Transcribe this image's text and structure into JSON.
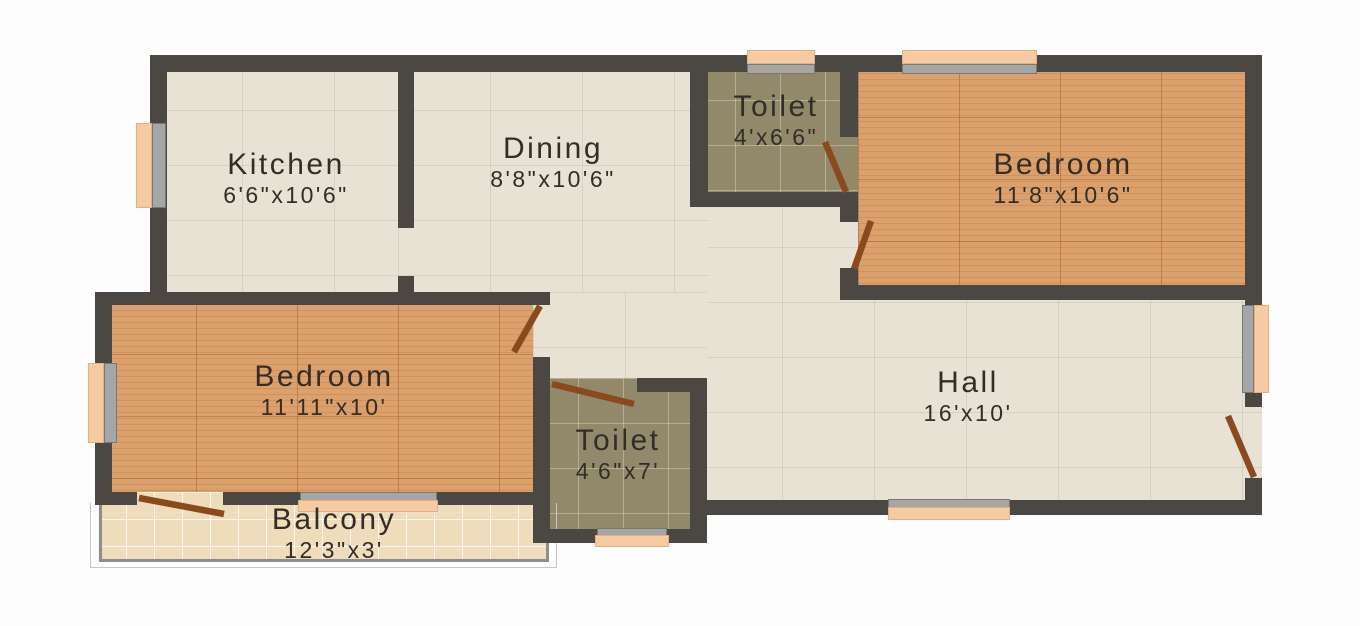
{
  "title": "2BHK Floor Plan",
  "colors": {
    "wall": "#4b4742",
    "floor_ceramic": "#e7e2d4",
    "floor_wood": "#dca06c",
    "floor_toilet_tile": "#92896b",
    "floor_balcony_tile": "#eedcba",
    "window_glass": "#f7cba2",
    "window_frame": "#a6a6a6",
    "door_leaf": "#8a4a1e",
    "label_text": "#332d27",
    "background": "#fdfdfd"
  },
  "rooms": [
    {
      "id": "kitchen",
      "name": "Kitchen",
      "dimensions": "6'6\"x10'6\"",
      "floor": "ceramic"
    },
    {
      "id": "dining",
      "name": "Dining",
      "dimensions": "8'8\"x10'6\"",
      "floor": "ceramic"
    },
    {
      "id": "toilet-top",
      "name": "Toilet",
      "dimensions": "4'x6'6\"",
      "floor": "toilet"
    },
    {
      "id": "bedroom-right",
      "name": "Bedroom",
      "dimensions": "11'8\"x10'6\"",
      "floor": "wood"
    },
    {
      "id": "bedroom-left",
      "name": "Bedroom",
      "dimensions": "11'11\"x10'",
      "floor": "wood"
    },
    {
      "id": "hall",
      "name": "Hall",
      "dimensions": "16'x10'",
      "floor": "ceramic"
    },
    {
      "id": "toilet-bottom",
      "name": "Toilet",
      "dimensions": "4'6\"x7'",
      "floor": "toilet"
    },
    {
      "id": "balcony",
      "name": "Balcony",
      "dimensions": "12'3\"x3'",
      "floor": "balcony"
    }
  ],
  "plan": {
    "width": 1360,
    "height": 626,
    "floors": [
      {
        "id": "hall",
        "type": "ceramic",
        "rect": [
          690,
          192,
          572,
          323
        ]
      },
      {
        "id": "bedroom-right",
        "type": "wood",
        "rect": [
          858,
          55,
          404,
          245
        ]
      },
      {
        "id": "toilet-top",
        "type": "toilet",
        "rect": [
          690,
          55,
          168,
          152
        ]
      },
      {
        "id": "kitchen",
        "type": "ceramic",
        "rect": [
          150,
          55,
          264,
          250
        ]
      },
      {
        "id": "dining",
        "type": "ceramic",
        "rect": [
          398,
          55,
          310,
          250
        ]
      },
      {
        "id": "bedroom-left",
        "type": "wood",
        "rect": [
          95,
          292,
          455,
          200
        ]
      },
      {
        "id": "corridor",
        "type": "ceramic",
        "rect": [
          533,
          292,
          174,
          100
        ]
      },
      {
        "id": "toilet-bottom",
        "type": "toilet",
        "rect": [
          533,
          378,
          174,
          165
        ]
      },
      {
        "id": "balcony",
        "type": "balcony",
        "rect": [
          98,
          492,
          450,
          70
        ]
      }
    ],
    "railing": [
      {
        "cls": "rail-outer",
        "rect": [
          90,
          503,
          467,
          65
        ]
      },
      {
        "cls": "rail-inner",
        "rect": [
          99,
          503,
          450,
          59
        ]
      }
    ],
    "walls": [
      [
        150,
        55,
        1112,
        17
      ],
      [
        150,
        55,
        17,
        250
      ],
      [
        398,
        72,
        16,
        156
      ],
      [
        398,
        276,
        16,
        29
      ],
      [
        690,
        55,
        18,
        152
      ],
      [
        690,
        192,
        168,
        15
      ],
      [
        840,
        72,
        18,
        65
      ],
      [
        840,
        192,
        18,
        30
      ],
      [
        840,
        268,
        18,
        32
      ],
      [
        1245,
        55,
        17,
        352
      ],
      [
        1245,
        478,
        17,
        37
      ],
      [
        840,
        285,
        422,
        15
      ],
      [
        690,
        500,
        572,
        15
      ],
      [
        95,
        292,
        455,
        13
      ],
      [
        95,
        292,
        17,
        213
      ],
      [
        95,
        492,
        42,
        13
      ],
      [
        223,
        492,
        214,
        13
      ],
      [
        437,
        492,
        113,
        13
      ],
      [
        533,
        357,
        17,
        186
      ],
      [
        637,
        378,
        70,
        14
      ],
      [
        690,
        378,
        17,
        165
      ],
      [
        533,
        529,
        174,
        14
      ]
    ],
    "windows": [
      {
        "id": "kitchen-window",
        "frame": [
          152,
          123,
          14,
          85
        ],
        "glass": [
          136,
          123,
          16,
          85
        ]
      },
      {
        "id": "bedroom-left-window",
        "frame": [
          104,
          363,
          13,
          80
        ],
        "glass": [
          88,
          363,
          16,
          80
        ]
      },
      {
        "id": "toilet-top-window",
        "frame": [
          747,
          64,
          68,
          10
        ],
        "glass": [
          747,
          50,
          68,
          14
        ]
      },
      {
        "id": "bedroom-right-window",
        "frame": [
          902,
          64,
          135,
          10
        ],
        "glass": [
          902,
          50,
          135,
          14
        ]
      },
      {
        "id": "hall-side-window",
        "frame": [
          1242,
          305,
          12,
          88
        ],
        "glass": [
          1254,
          305,
          15,
          88
        ]
      },
      {
        "id": "hall-bottom-window",
        "frame": [
          888,
          499,
          122,
          9
        ],
        "glass": [
          888,
          507,
          122,
          13
        ]
      },
      {
        "id": "balcony-sliding-window",
        "frame": [
          300,
          492,
          137,
          9
        ],
        "glass": [
          298,
          500,
          140,
          12
        ]
      },
      {
        "id": "toilet-bottom-window",
        "frame": [
          597,
          528,
          70,
          8
        ],
        "glass": [
          595,
          535,
          74,
          12
        ]
      }
    ],
    "doors": [
      {
        "id": "balcony-door",
        "line": [
          139,
          498,
          224,
          514
        ]
      },
      {
        "id": "bedroom-left-door",
        "line": [
          540,
          306,
          514,
          352
        ]
      },
      {
        "id": "toilet-bottom-door",
        "line": [
          552,
          384,
          634,
          404
        ]
      },
      {
        "id": "toilet-top-door",
        "line": [
          825,
          142,
          846,
          192
        ]
      },
      {
        "id": "bedroom-right-door",
        "line": [
          871,
          221,
          854,
          269
        ]
      },
      {
        "id": "main-entrance-door",
        "line": [
          1228,
          416,
          1254,
          477
        ]
      }
    ]
  }
}
